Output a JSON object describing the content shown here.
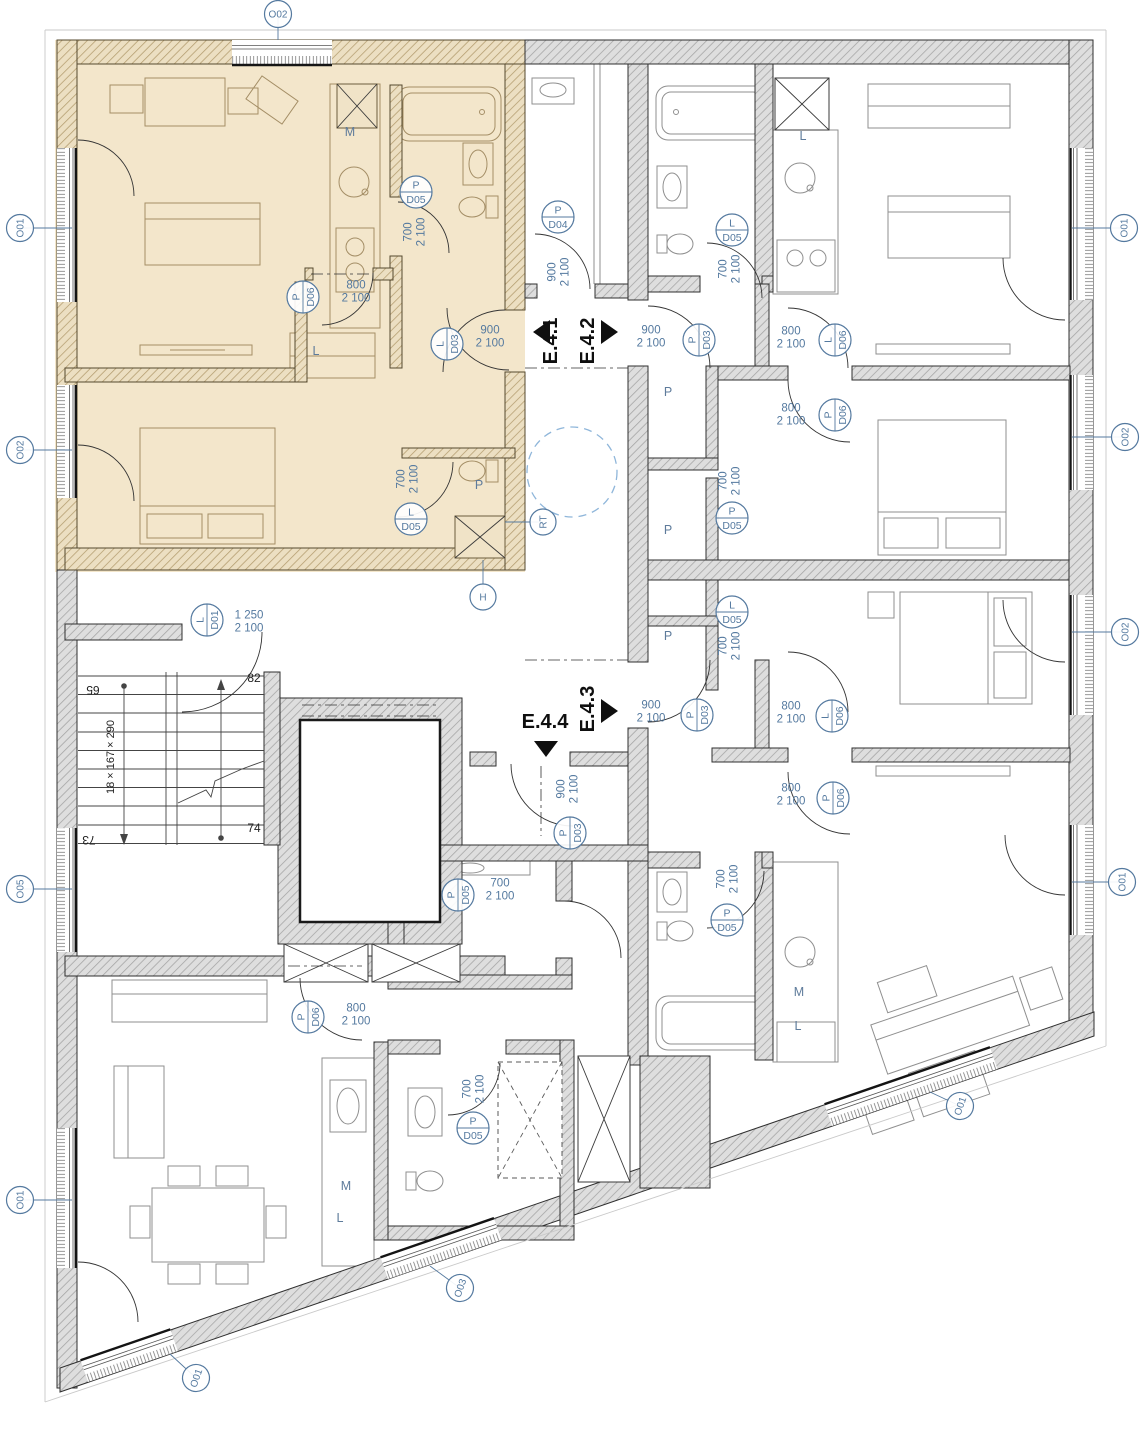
{
  "drawing": {
    "type": "apartment floor plan",
    "highlighted_unit": "E.4.1"
  },
  "colors": {
    "highlight": "#f3e6cb",
    "label_blue": "#54799f",
    "dashed_circle": "#8fb6da"
  },
  "entrances": [
    {
      "label": "E.4.1",
      "x": 557,
      "y": 341,
      "rot": -90,
      "tx": 550,
      "ty": 332,
      "dir": "left"
    },
    {
      "label": "E.4.2",
      "x": 594,
      "y": 341,
      "rot": -90,
      "tx": 601,
      "ty": 332,
      "dir": "right"
    },
    {
      "label": "E.4.3",
      "x": 594,
      "y": 709,
      "rot": -90,
      "tx": 601,
      "ty": 711,
      "dir": "right"
    },
    {
      "label": "E.4.4",
      "x": 545,
      "y": 728,
      "rot": 0,
      "tx": 546,
      "ty": 741,
      "dir": "down"
    }
  ],
  "door_tags": [
    {
      "letter": "P",
      "code": "D06",
      "x": 303,
      "y": 297,
      "rot": -90
    },
    {
      "letter": "L",
      "code": "D03",
      "x": 447,
      "y": 344,
      "rot": -90
    },
    {
      "letter": "P",
      "code": "D03",
      "x": 699,
      "y": 340,
      "rot": -90
    },
    {
      "letter": "P",
      "code": "D04",
      "x": 558,
      "y": 217,
      "rot": 0
    },
    {
      "letter": "P",
      "code": "D05",
      "x": 416,
      "y": 192,
      "rot": 0
    },
    {
      "letter": "L",
      "code": "D05",
      "x": 411,
      "y": 519,
      "rot": 0
    },
    {
      "letter": "L",
      "code": "D05",
      "x": 732,
      "y": 230,
      "rot": 0
    },
    {
      "letter": "L",
      "code": "D06",
      "x": 835,
      "y": 340,
      "rot": -90
    },
    {
      "letter": "P",
      "code": "D06",
      "x": 835,
      "y": 415,
      "rot": -90
    },
    {
      "letter": "P",
      "code": "D05",
      "x": 732,
      "y": 518,
      "rot": 0
    },
    {
      "letter": "L",
      "code": "D05",
      "x": 732,
      "y": 612,
      "rot": 0
    },
    {
      "letter": "P",
      "code": "D03",
      "x": 697,
      "y": 715,
      "rot": -90
    },
    {
      "letter": "L",
      "code": "D06",
      "x": 832,
      "y": 716,
      "rot": -90
    },
    {
      "letter": "P",
      "code": "D06",
      "x": 833,
      "y": 798,
      "rot": -90
    },
    {
      "letter": "P",
      "code": "D03",
      "x": 570,
      "y": 833,
      "rot": -90
    },
    {
      "letter": "P",
      "code": "D05",
      "x": 727,
      "y": 920,
      "rot": 0
    },
    {
      "letter": "P",
      "code": "D05",
      "x": 458,
      "y": 895,
      "rot": -90
    },
    {
      "letter": "P",
      "code": "D06",
      "x": 308,
      "y": 1017,
      "rot": -90
    },
    {
      "letter": "P",
      "code": "D05",
      "x": 473,
      "y": 1128,
      "rot": 0
    },
    {
      "letter": "L",
      "code": "D01",
      "x": 207,
      "y": 620,
      "rot": -90
    }
  ],
  "window_tags": [
    {
      "label": "O02",
      "x": 278,
      "y": 14,
      "rot": 0,
      "lx": 278,
      "ly": 40
    },
    {
      "label": "O01",
      "x": 20,
      "y": 228,
      "rot": -90,
      "lx": 72,
      "ly": 228
    },
    {
      "label": "O02",
      "x": 20,
      "y": 450,
      "rot": -90,
      "lx": 72,
      "ly": 450
    },
    {
      "label": "O05",
      "x": 20,
      "y": 889,
      "rot": -90,
      "lx": 72,
      "ly": 889
    },
    {
      "label": "O01",
      "x": 20,
      "y": 1200,
      "rot": -90,
      "lx": 72,
      "ly": 1200
    },
    {
      "label": "O01",
      "x": 1124,
      "y": 228,
      "rot": -90,
      "lx": 1072,
      "ly": 228
    },
    {
      "label": "O02",
      "x": 1125,
      "y": 437,
      "rot": -90,
      "lx": 1072,
      "ly": 437
    },
    {
      "label": "O02",
      "x": 1125,
      "y": 632,
      "rot": -90,
      "lx": 1072,
      "ly": 632
    },
    {
      "label": "O01",
      "x": 1122,
      "y": 882,
      "rot": -90,
      "lx": 1072,
      "ly": 882
    },
    {
      "label": "O01",
      "x": 960,
      "y": 1106,
      "rot": -71,
      "lx": 930,
      "ly": 1092
    },
    {
      "label": "O03",
      "x": 460,
      "y": 1288,
      "rot": -71,
      "lx": 430,
      "ly": 1266
    },
    {
      "label": "O01",
      "x": 196,
      "y": 1378,
      "rot": -71,
      "lx": 170,
      "ly": 1354
    }
  ],
  "dims": [
    {
      "a": "800",
      "b": "2 100",
      "x": 356,
      "y": 291,
      "rot": 0
    },
    {
      "a": "900",
      "b": "2 100",
      "x": 490,
      "y": 336,
      "rot": 0
    },
    {
      "a": "900",
      "b": "2 100",
      "x": 651,
      "y": 336,
      "rot": 0
    },
    {
      "a": "900",
      "b": "2 100",
      "x": 558,
      "y": 272,
      "rot": -90
    },
    {
      "a": "700",
      "b": "2 100",
      "x": 414,
      "y": 232,
      "rot": -90
    },
    {
      "a": "700",
      "b": "2 100",
      "x": 407,
      "y": 479,
      "rot": -90
    },
    {
      "a": "700",
      "b": "2 100",
      "x": 729,
      "y": 269,
      "rot": -90
    },
    {
      "a": "800",
      "b": "2 100",
      "x": 791,
      "y": 337,
      "rot": 0
    },
    {
      "a": "800",
      "b": "2 100",
      "x": 791,
      "y": 414,
      "rot": 0
    },
    {
      "a": "700",
      "b": "2 100",
      "x": 729,
      "y": 481,
      "rot": -90
    },
    {
      "a": "700",
      "b": "2 100",
      "x": 729,
      "y": 646,
      "rot": -90
    },
    {
      "a": "900",
      "b": "2 100",
      "x": 651,
      "y": 711,
      "rot": 0
    },
    {
      "a": "800",
      "b": "2 100",
      "x": 791,
      "y": 712,
      "rot": 0
    },
    {
      "a": "800",
      "b": "2 100",
      "x": 791,
      "y": 794,
      "rot": 0
    },
    {
      "a": "900",
      "b": "2 100",
      "x": 567,
      "y": 789,
      "rot": -90
    },
    {
      "a": "700",
      "b": "2 100",
      "x": 727,
      "y": 879,
      "rot": -90
    },
    {
      "a": "700",
      "b": "2 100",
      "x": 500,
      "y": 889,
      "rot": 0
    },
    {
      "a": "800",
      "b": "2 100",
      "x": 356,
      "y": 1014,
      "rot": 0
    },
    {
      "a": "700",
      "b": "2 100",
      "x": 473,
      "y": 1089,
      "rot": -90
    },
    {
      "a": "1 250",
      "b": "2 100",
      "x": 249,
      "y": 621,
      "rot": 0
    }
  ],
  "room_letters": [
    {
      "t": "M",
      "x": 350,
      "y": 136
    },
    {
      "t": "L",
      "x": 316,
      "y": 355
    },
    {
      "t": "P",
      "x": 479,
      "y": 489
    },
    {
      "t": "L",
      "x": 803,
      "y": 140
    },
    {
      "t": "P",
      "x": 668,
      "y": 396
    },
    {
      "t": "P",
      "x": 668,
      "y": 534
    },
    {
      "t": "P",
      "x": 668,
      "y": 640
    },
    {
      "t": "M",
      "x": 799,
      "y": 996
    },
    {
      "t": "L",
      "x": 798,
      "y": 1030
    },
    {
      "t": "M",
      "x": 346,
      "y": 1190
    },
    {
      "t": "L",
      "x": 340,
      "y": 1222
    }
  ],
  "stair": {
    "formula": "18 × 167 × 290",
    "top_left": "65",
    "top_right": "82",
    "bottom_left": "73",
    "bottom_right": "74"
  },
  "misc_tags": [
    {
      "label": "RT",
      "x": 543,
      "y": 522,
      "rot": -90,
      "lx": 505,
      "ly": 522
    },
    {
      "label": "H",
      "x": 483,
      "y": 597,
      "rot": 0,
      "lx": 483,
      "ly": 560
    }
  ]
}
